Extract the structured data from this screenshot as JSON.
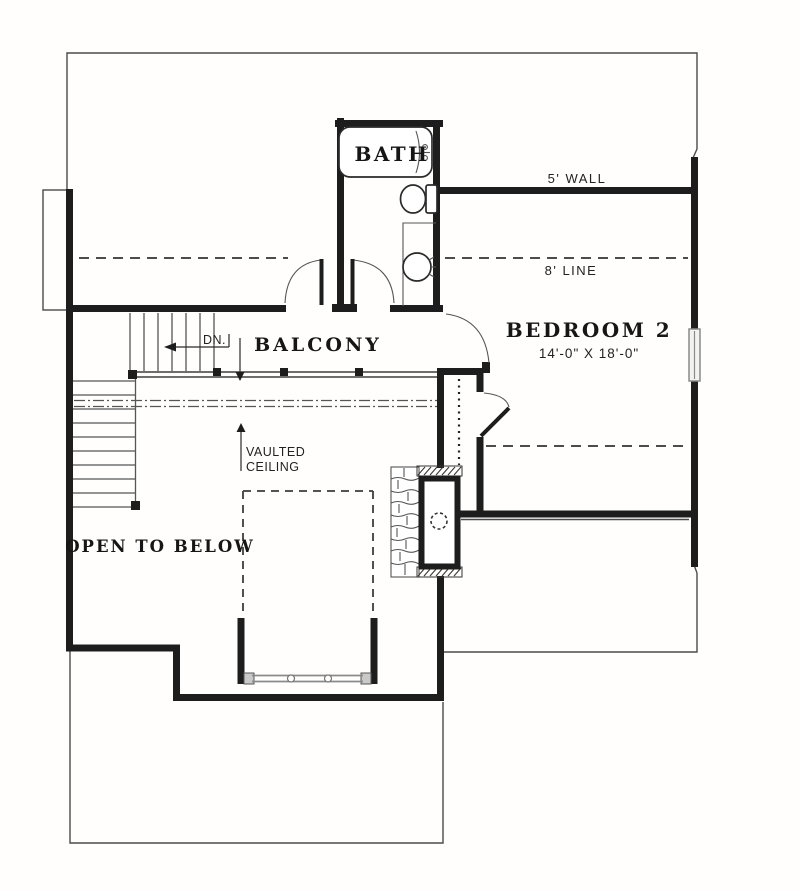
{
  "plan": {
    "type": "floor-plan",
    "floor": "second-floor",
    "labels": {
      "bath": "BATH",
      "balcony": "BALCONY",
      "bedroom2": "BEDROOM 2",
      "bedroom2_dims": "14'-0\" X 18'-0\"",
      "open_to_below": "OPEN TO BELOW",
      "vaulted_line1": "VAULTED",
      "vaulted_line2": "CEILING",
      "wall_5ft": "5' WALL",
      "line_8ft": "8' LINE",
      "down": "DN."
    },
    "rooms": [
      {
        "name": "BATH",
        "dimensions": ""
      },
      {
        "name": "BALCONY",
        "dimensions": ""
      },
      {
        "name": "BEDROOM 2",
        "dimensions": "14'-0\" X 18'-0\""
      },
      {
        "name": "OPEN TO BELOW",
        "dimensions": ""
      }
    ],
    "annotations": [
      "5' WALL",
      "8' LINE",
      "DN.",
      "VAULTED CEILING"
    ],
    "features": [
      "bathtub-icon",
      "toilet-icon",
      "sink-icon",
      "fireplace-chimney-icon",
      "staircase",
      "railing",
      "bay-window",
      "double-access-doors",
      "bedroom-window",
      "roof-outline"
    ],
    "colors": {
      "wall": "#1d1d1d",
      "thin_line": "#4a4a4a",
      "glazing": "#8a8a8a",
      "background": "#fffefd"
    }
  }
}
